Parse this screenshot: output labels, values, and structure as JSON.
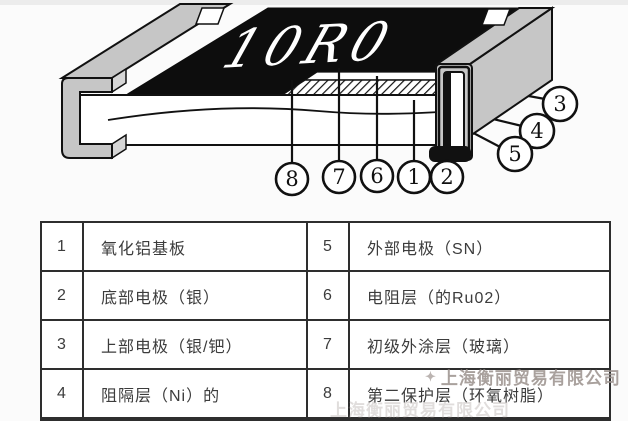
{
  "diagram": {
    "chip_marking": "10R0",
    "callouts": {
      "c1": "1",
      "c2": "2",
      "c3": "3",
      "c4": "4",
      "c5": "5",
      "c6": "6",
      "c7": "7",
      "c8": "8"
    }
  },
  "table": {
    "rows": [
      {
        "num": "1",
        "desc": "氧化铝基板",
        "num2": "5",
        "desc2": "外部电极（SN）"
      },
      {
        "num": "2",
        "desc": "底部电极（银）",
        "num2": "6",
        "desc2": "电阻层（的Ru02）"
      },
      {
        "num": "3",
        "desc": "上部电极（银/钯）",
        "num2": "7",
        "desc2": "初级外涂层（玻璃）"
      },
      {
        "num": "4",
        "desc": "阻隔层（Ni）的",
        "num2": "8",
        "desc2": "第二保护层（环氧树脂）"
      }
    ]
  },
  "watermark": {
    "company": "上海衡丽贸易有限公司"
  },
  "colors": {
    "body_gray": "#c6c6c6",
    "ink": "#111111",
    "watermark_gray": "#9b918d",
    "table_border": "#2e2e2e"
  }
}
